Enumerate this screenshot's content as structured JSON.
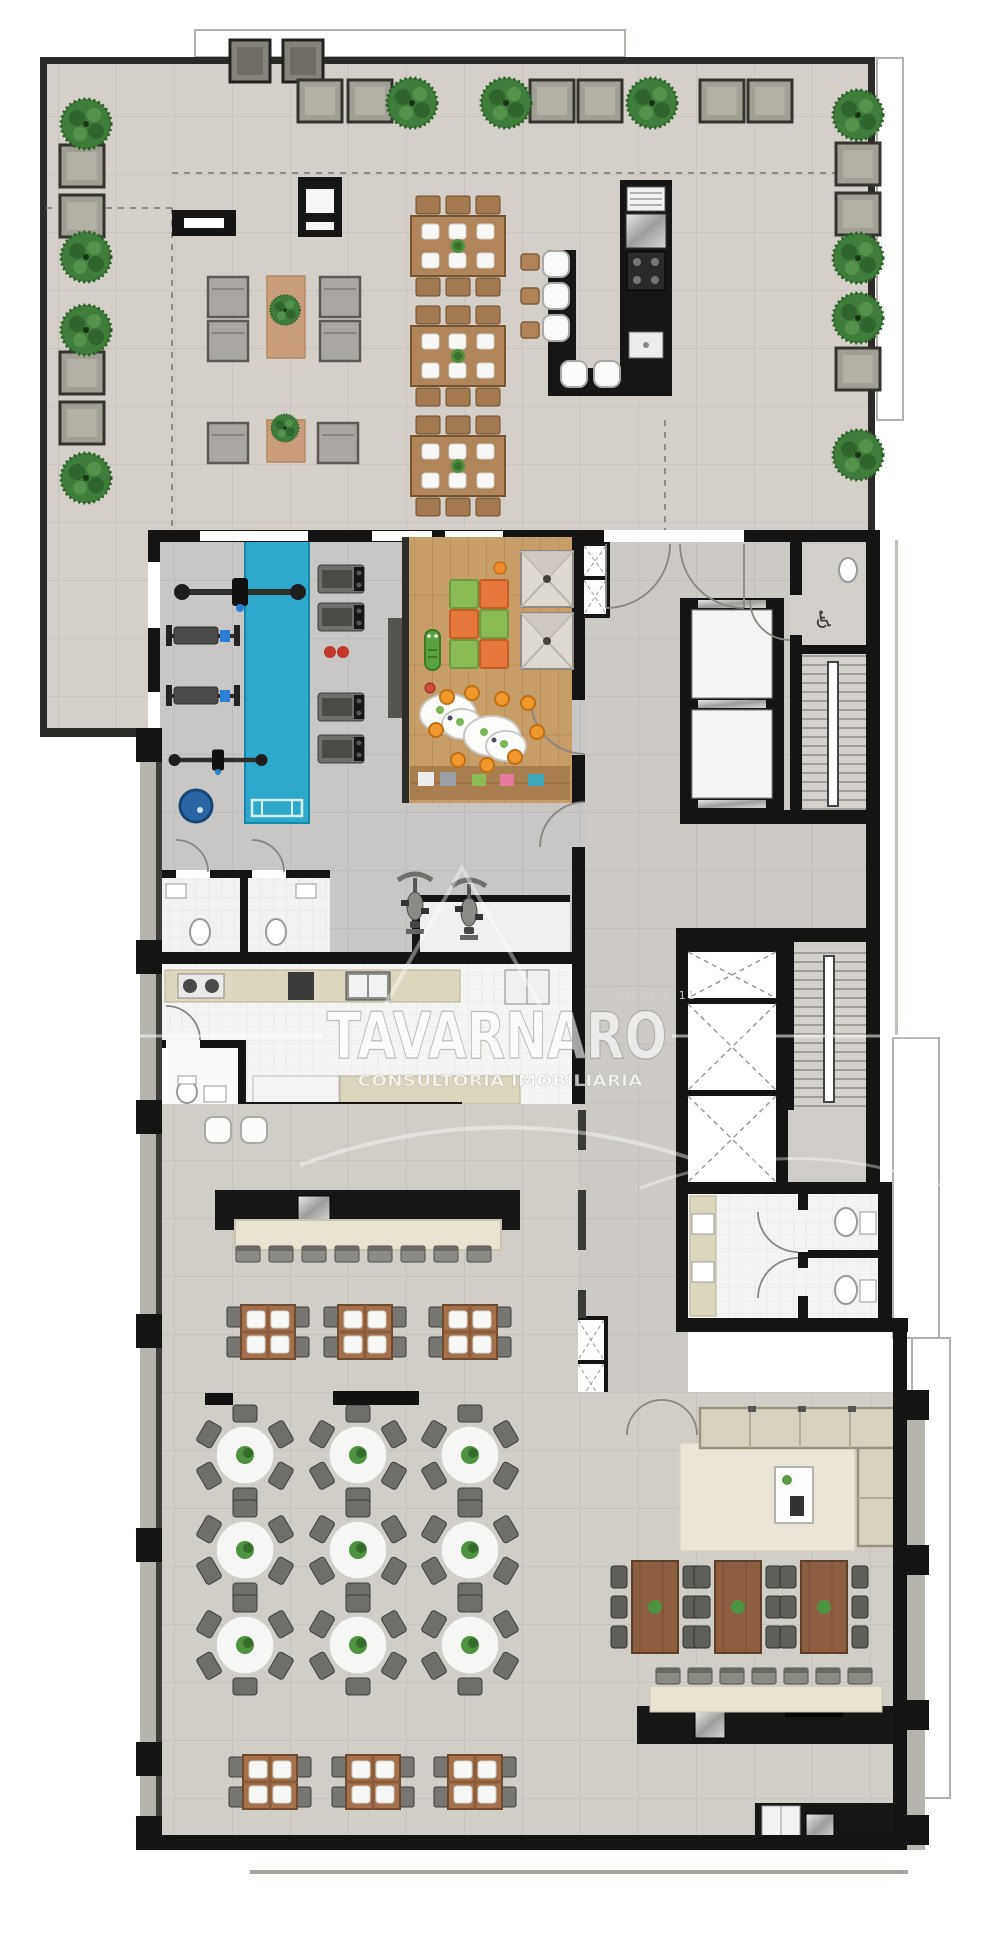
{
  "watermark": {
    "title": "TAVARNARO",
    "subtitle": "CONSULTORIA IMOBILIÁRIA",
    "registry": "CRECI 3411"
  },
  "icons": {
    "accessible_wc": "♿"
  },
  "palette": {
    "wall": "#161616",
    "terrace_floor": "#d4d0c9",
    "hall_floor": "#d1cec7",
    "gym_floor": "#c8c7c5",
    "kitchen_floor": "#f4f4f2",
    "wood_floor": "#c79e68",
    "pool": "#2ea9cc",
    "spa": "#2a66a3",
    "mat_orange": "#e5773c",
    "mat_green": "#8cba55",
    "tree": "#3e7d3a",
    "counter_black": "#161616",
    "cream": "#e9e4d2",
    "sofa": "#d7d1bf",
    "table_wood": "#a5714c",
    "chair_gray": "#6e6e6a",
    "chair_tan": "#b08356",
    "plate_white": "#f6f6f4"
  },
  "floorplan": {
    "items": {
      "rug80": [
        [
          267,
          276
        ]
      ],
      "rug40": [
        [
          267,
          420
        ]
      ],
      "lounger": [
        [
          208,
          277
        ],
        [
          208,
          321
        ],
        [
          320,
          277
        ],
        [
          320,
          321
        ],
        [
          208,
          423
        ],
        [
          318,
          423
        ]
      ],
      "planterDark": [
        [
          230,
          40
        ],
        [
          283,
          40
        ]
      ],
      "planter": [
        [
          298,
          80
        ],
        [
          348,
          80
        ],
        [
          530,
          80
        ],
        [
          578,
          80
        ],
        [
          700,
          80
        ],
        [
          748,
          80
        ],
        [
          60,
          145
        ],
        [
          60,
          195
        ],
        [
          60,
          352
        ],
        [
          60,
          402
        ],
        [
          836,
          143
        ],
        [
          836,
          193
        ],
        [
          836,
          348
        ]
      ],
      "table6": [
        [
          458,
          246
        ],
        [
          458,
          356
        ],
        [
          458,
          466
        ]
      ],
      "sqtable": [
        [
          268,
          1332
        ],
        [
          365,
          1332
        ],
        [
          470,
          1332
        ],
        [
          270,
          1782
        ],
        [
          373,
          1782
        ],
        [
          475,
          1782
        ]
      ],
      "roundtable": [
        [
          245,
          1455
        ],
        [
          358,
          1455
        ],
        [
          470,
          1455
        ],
        [
          245,
          1550
        ],
        [
          358,
          1550
        ],
        [
          470,
          1550
        ],
        [
          245,
          1645
        ],
        [
          358,
          1645
        ],
        [
          470,
          1645
        ]
      ],
      "vtable": [
        [
          655,
          1607
        ],
        [
          738,
          1607
        ],
        [
          824,
          1607
        ]
      ],
      "chairUp": [
        [
          248,
          1254
        ],
        [
          281,
          1254
        ],
        [
          314,
          1254
        ],
        [
          347,
          1254
        ],
        [
          380,
          1254
        ],
        [
          413,
          1254
        ],
        [
          446,
          1254
        ],
        [
          479,
          1254
        ],
        [
          668,
          1676
        ],
        [
          700,
          1676
        ],
        [
          732,
          1676
        ],
        [
          764,
          1676
        ],
        [
          796,
          1676
        ],
        [
          828,
          1676
        ],
        [
          860,
          1676
        ]
      ],
      "treadmill": [
        [
          318,
          565
        ],
        [
          318,
          603
        ],
        [
          318,
          693
        ],
        [
          318,
          735
        ]
      ],
      "bench": [
        [
          166,
          622
        ],
        [
          166,
          682
        ]
      ],
      "cable": [
        [
          240,
          592
        ],
        [
          218,
          760,
          0.75
        ]
      ],
      "spinbike": [
        [
          398,
          874
        ],
        [
          452,
          880
        ]
      ],
      "matG": [
        [
          450,
          580
        ],
        [
          480,
          610
        ],
        [
          450,
          640
        ]
      ],
      "matO": [
        [
          480,
          580
        ],
        [
          450,
          610
        ],
        [
          480,
          640
        ]
      ],
      "teepee": [
        [
          521,
          551
        ],
        [
          521,
          613
        ]
      ],
      "croc": [
        [
          425,
          630
        ]
      ],
      "kidtable": [
        [
          448,
          714
        ],
        [
          492,
          736
        ]
      ],
      "stoolO": [
        [
          447,
          697
        ],
        [
          472,
          693
        ],
        [
          502,
          699
        ],
        [
          528,
          703
        ],
        [
          436,
          730
        ],
        [
          458,
          760
        ],
        [
          487,
          765
        ],
        [
          515,
          757
        ],
        [
          537,
          732
        ]
      ],
      "stoolW": [
        [
          556,
          264
        ],
        [
          556,
          296
        ],
        [
          556,
          328
        ],
        [
          574,
          374
        ],
        [
          607,
          374
        ],
        [
          218,
          1130
        ],
        [
          254,
          1130
        ]
      ],
      "chairT": [
        [
          530,
          262
        ],
        [
          530,
          296
        ],
        [
          530,
          330
        ]
      ],
      "tree": [
        [
          412,
          103
        ],
        [
          506,
          103
        ],
        [
          652,
          103
        ],
        [
          858,
          115
        ],
        [
          86,
          124
        ],
        [
          86,
          257
        ],
        [
          86,
          330
        ],
        [
          86,
          478
        ],
        [
          858,
          258
        ],
        [
          858,
          318
        ],
        [
          858,
          455
        ],
        [
          285,
          310,
          0.6
        ],
        [
          285,
          428,
          0.55
        ]
      ]
    },
    "rects": [
      [
        172,
        210,
        64,
        26,
        "#151515"
      ],
      [
        184,
        218,
        40,
        10,
        "#ffffff"
      ],
      [
        298,
        177,
        44,
        60,
        "#151515"
      ],
      [
        306,
        189,
        28,
        24,
        "#f5f5f3"
      ],
      [
        306,
        222,
        28,
        8,
        "#f5f5f3"
      ],
      [
        205,
        1393,
        28,
        12,
        "#111111"
      ],
      [
        333,
        1391,
        86,
        14,
        "#111111"
      ],
      [
        418,
        772,
        16,
        14,
        "#ececea"
      ],
      [
        440,
        772,
        16,
        14,
        "#9aa0a6"
      ],
      [
        472,
        774,
        14,
        12,
        "#8cba55"
      ],
      [
        500,
        774,
        14,
        12,
        "#e579a0"
      ],
      [
        528,
        774,
        16,
        12,
        "#3da6b8"
      ]
    ],
    "circles": [
      [
        190,
        986,
        7,
        "#4a4a48"
      ],
      [
        212,
        986,
        7,
        "#4a4a48"
      ],
      [
        330,
        652,
        6,
        "#c0392b"
      ],
      [
        343,
        652,
        6,
        "#c0392b"
      ]
    ]
  }
}
